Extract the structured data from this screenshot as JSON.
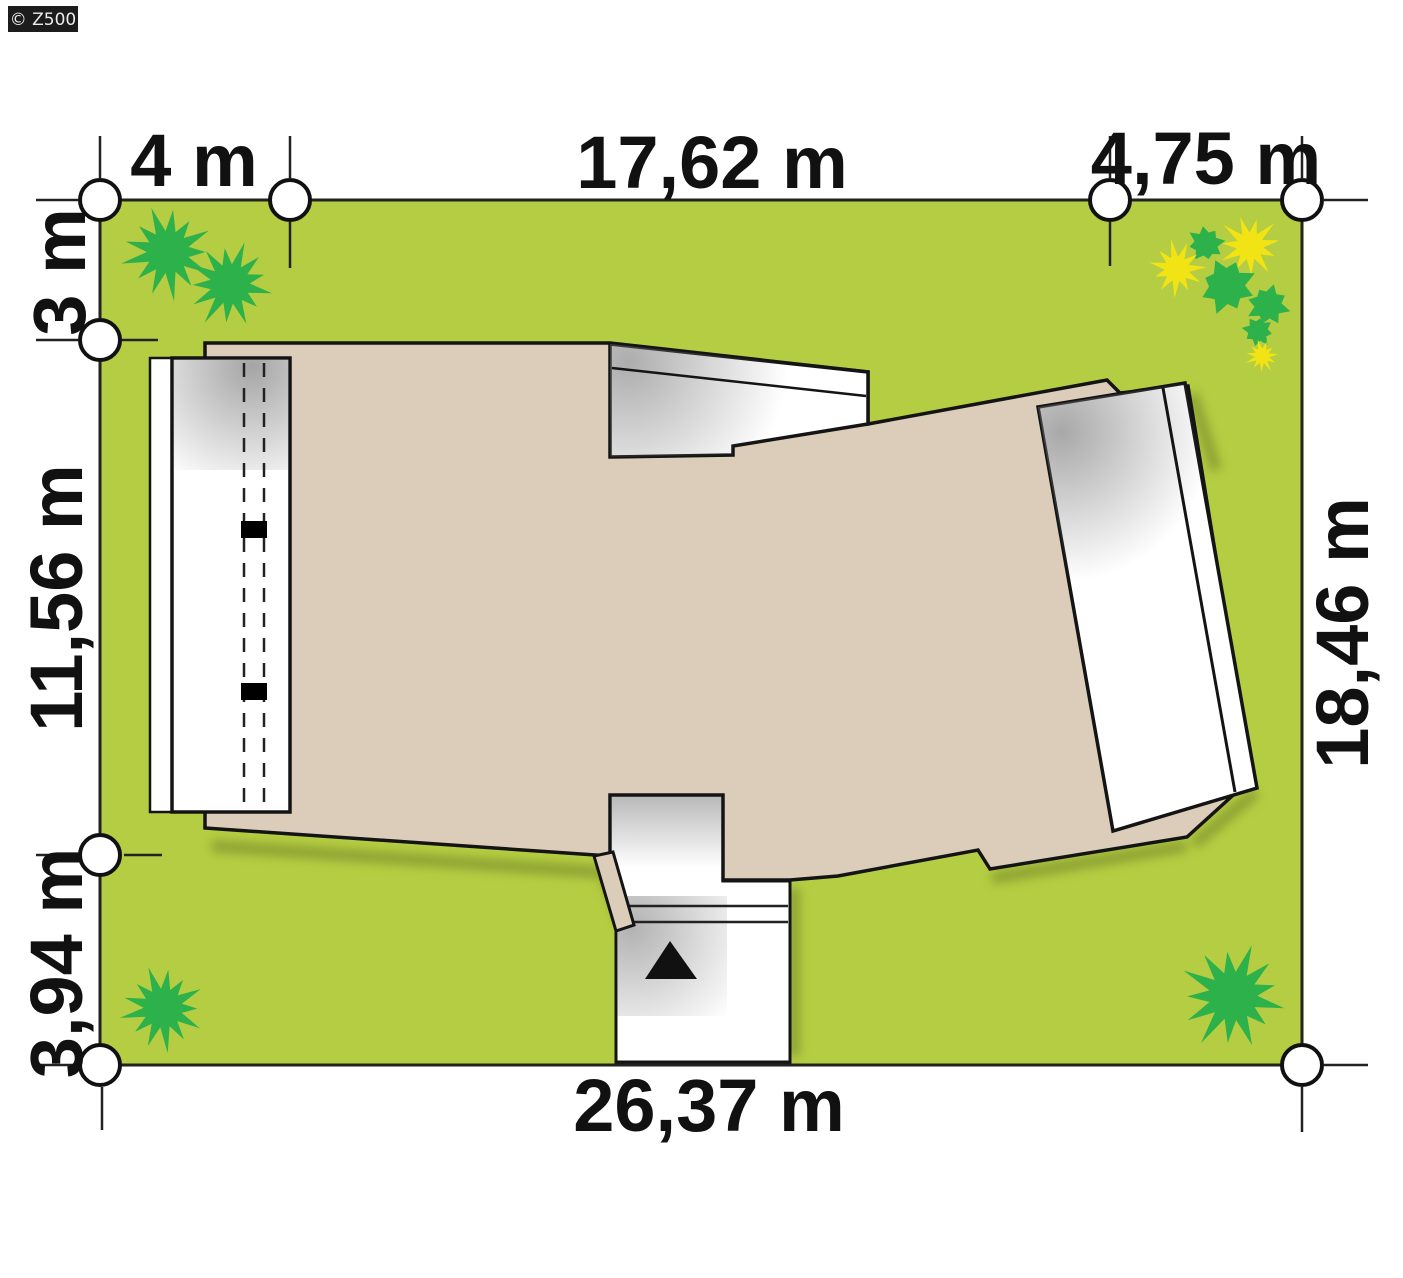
{
  "watermark": {
    "text": "© Z500"
  },
  "dimensions": {
    "top": [
      "4 m",
      "17,62 m",
      "4,75 m"
    ],
    "left": [
      "3 m",
      "11,56 m",
      "3,94 m"
    ],
    "right": [
      "18,46 m"
    ],
    "bottom": [
      "26,37 m"
    ]
  },
  "colors": {
    "grass": "#b5cd42",
    "roof": "#dccdbb",
    "white_area": "#ffffff",
    "bush_green": "#2db14b",
    "flower_yellow": "#f2e414",
    "outline": "#141414",
    "label_text": "#111111",
    "watermark_bg": "#1c1c1c",
    "watermark_text": "#ececec"
  },
  "plants": [
    {
      "type": "bush",
      "x": 168,
      "y": 252,
      "r": 47,
      "color": "bush_green"
    },
    {
      "type": "bush",
      "x": 230,
      "y": 284,
      "r": 44,
      "color": "bush_green"
    },
    {
      "type": "blob",
      "x": 1206,
      "y": 244,
      "r": 19,
      "color": "bush_green"
    },
    {
      "type": "flower",
      "x": 1250,
      "y": 246,
      "r": 32,
      "color": "flower_yellow"
    },
    {
      "type": "flower",
      "x": 1177,
      "y": 269,
      "r": 29,
      "color": "flower_yellow"
    },
    {
      "type": "blob",
      "x": 1227,
      "y": 286,
      "r": 29,
      "color": "bush_green"
    },
    {
      "type": "blob",
      "x": 1268,
      "y": 305,
      "r": 22,
      "color": "bush_green"
    },
    {
      "type": "blob",
      "x": 1258,
      "y": 331,
      "r": 16,
      "color": "bush_green"
    },
    {
      "type": "flower",
      "x": 1262,
      "y": 356,
      "r": 17,
      "color": "flower_yellow"
    },
    {
      "type": "bush",
      "x": 163,
      "y": 1008,
      "r": 43,
      "color": "bush_green"
    },
    {
      "type": "bush",
      "x": 1233,
      "y": 996,
      "r": 54,
      "color": "bush_green"
    }
  ]
}
